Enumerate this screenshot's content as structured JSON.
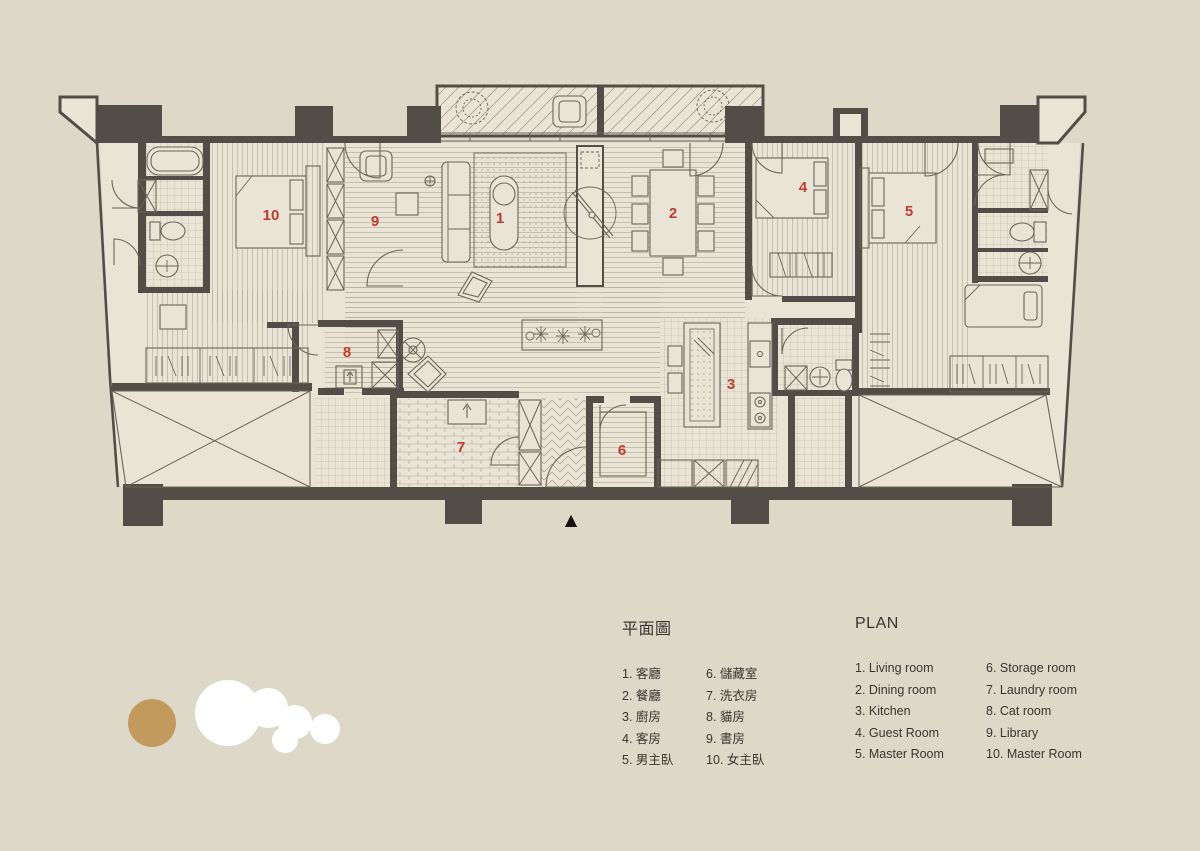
{
  "plan": {
    "north_arrow": "▲"
  },
  "legend": {
    "title_zh": "平面圖",
    "title_en": "PLAN"
  },
  "rooms": [
    {
      "num": "1",
      "zh": "1. 客廳",
      "en": "1. Living room"
    },
    {
      "num": "2",
      "zh": "2. 餐廳",
      "en": "2. Dining room"
    },
    {
      "num": "3",
      "zh": "3. 廚房",
      "en": "3. Kitchen"
    },
    {
      "num": "4",
      "zh": "4. 客房",
      "en": "4. Guest Room"
    },
    {
      "num": "5",
      "zh": "5. 男主臥",
      "en": "5. Master Room"
    },
    {
      "num": "6",
      "zh": "6. 儲藏室",
      "en": "6. Storage room"
    },
    {
      "num": "7",
      "zh": "7. 洗衣房",
      "en": "7. Laundry room"
    },
    {
      "num": "8",
      "zh": "8. 貓房",
      "en": "8. Cat room"
    },
    {
      "num": "9",
      "zh": "9. 書房",
      "en": "9. Library"
    },
    {
      "num": "10",
      "zh": "10. 女主臥",
      "en": "10. Master Room"
    }
  ],
  "colors": {
    "background": "#ded8c9",
    "floor": "#e9e4d5",
    "wall": "#524e47",
    "line": "#6b655a",
    "hatch": "#b8b09e",
    "accent_red": "#c53a2e",
    "logo_gold": "#c39a5d",
    "logo_white": "#ffffff"
  }
}
